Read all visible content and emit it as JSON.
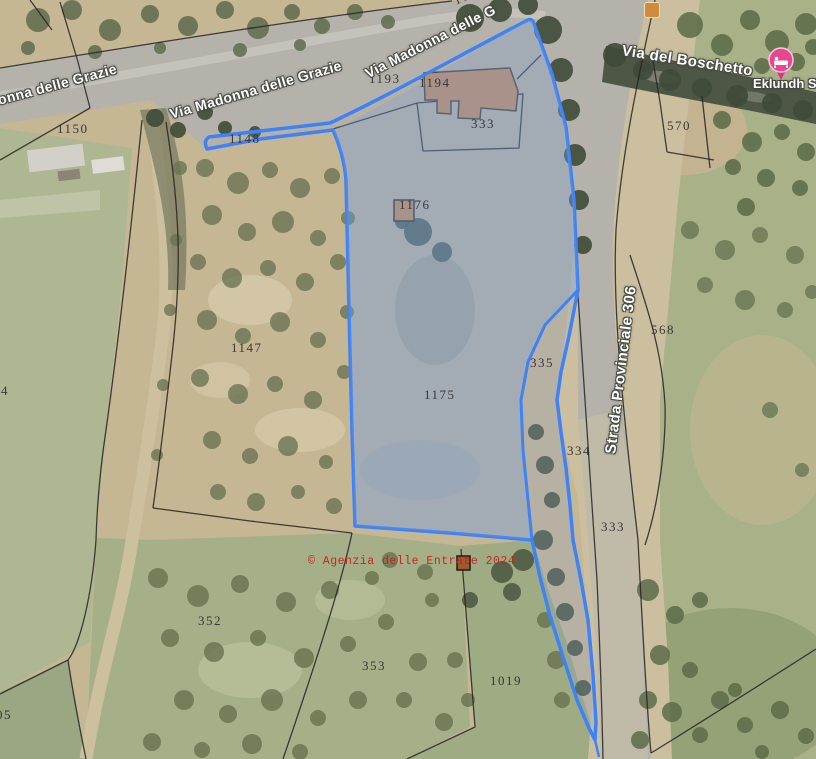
{
  "map": {
    "attribution": "© Agenzia delle Entrate 2024",
    "colors": {
      "highlight_stroke": "#3e82f5",
      "highlight_fill": "rgba(110,160,235,0.26)",
      "watermark_red": "#c81e1e",
      "poi_pin_pink": "#e8468f",
      "building_orange": "#cf8c4e"
    },
    "roads": {
      "grazie_left": "onna delle Grazie",
      "grazie_mid": "Via Madonna delle Grazie",
      "grazie_top": "Via Madonna delle G",
      "boschetto": "Via del Boschetto",
      "sp306": "Strada Provinciale 306"
    },
    "poi": {
      "lodging_name": "Eklundh S"
    },
    "parcels": [
      {
        "label": "1150"
      },
      {
        "label": "1148"
      },
      {
        "label": "1193"
      },
      {
        "label": "1194"
      },
      {
        "label": "333"
      },
      {
        "label": "570"
      },
      {
        "label": "1176"
      },
      {
        "label": "1147"
      },
      {
        "label": "1175"
      },
      {
        "label": "335"
      },
      {
        "label": "568"
      },
      {
        "label": "334"
      },
      {
        "label": "333"
      },
      {
        "label": "352"
      },
      {
        "label": "353"
      },
      {
        "label": "1019"
      },
      {
        "label": "4"
      },
      {
        "label": "05"
      },
      {
        "label": "1172"
      }
    ]
  }
}
